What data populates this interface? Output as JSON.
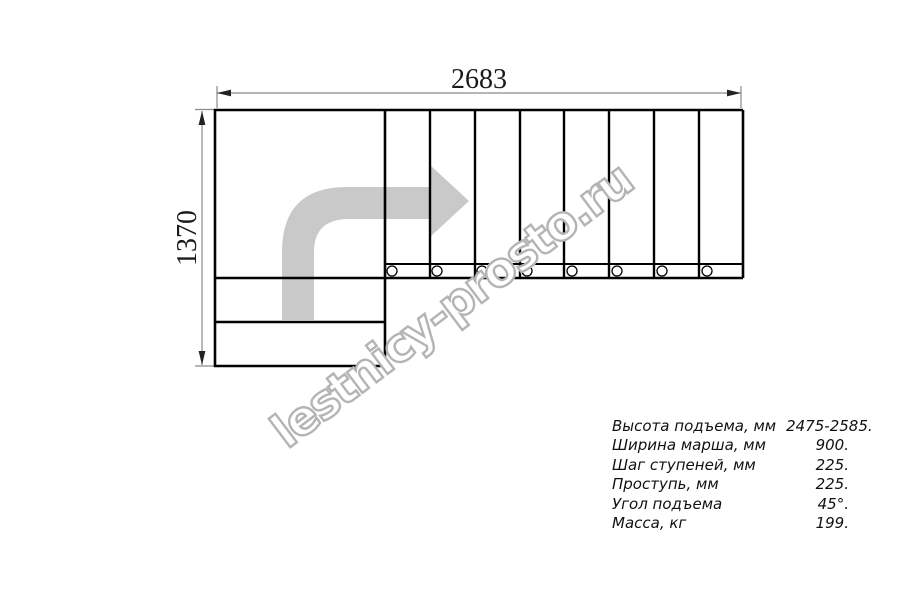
{
  "diagram": {
    "type": "stair-plan-top-view",
    "width_label": "2683",
    "height_label": "1370",
    "upper_flight_steps_count": 8,
    "lower_flight_steps_count": 2,
    "stringer_bolts_count": 8,
    "turn_direction": "up-then-right"
  },
  "watermark": {
    "text": "lestnicy-prosto.ru"
  },
  "specs": {
    "rows": [
      {
        "label": "Высота подъема, мм",
        "value": "2475-2585."
      },
      {
        "label": "Ширина марша, мм",
        "value": "900."
      },
      {
        "label": "Шаг ступеней, мм",
        "value": "225."
      },
      {
        "label": "Проступь, мм",
        "value": "225."
      },
      {
        "label": "Угол подъема",
        "value": "45°."
      },
      {
        "label": "Масса, кг",
        "value": "199."
      }
    ]
  },
  "colors": {
    "outline": "#000000",
    "divider": "#000000",
    "dimension_line": "#8a8a8a",
    "dimension_arrow": "#222222",
    "direction_arrow": "#c9c9c9",
    "watermark_stroke": "#b4b4b4",
    "background": "#ffffff"
  }
}
